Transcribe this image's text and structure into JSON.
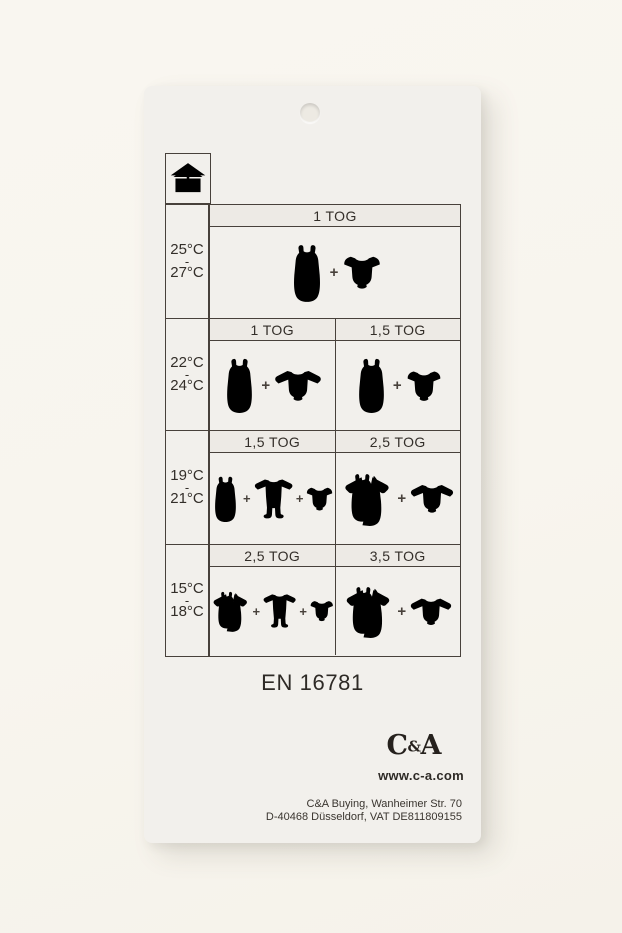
{
  "colors": {
    "backdrop": "#f8f5ee",
    "tag": "#f2f0ec",
    "ink": "#48413b",
    "text": "#332e29",
    "icon_fill": "#e9e6e1",
    "header_bg": "#edeae5"
  },
  "legend": {
    "icon": "house-thermometer-icon"
  },
  "table": {
    "plus": "+",
    "rows": [
      {
        "temp_from": "25°C",
        "temp_sep": "-",
        "temp_to": "27°C",
        "cells": [
          {
            "tog": "1 TOG",
            "items": [
              "sleeping-bag-icon",
              "bodysuit-short-sleeve-icon"
            ]
          }
        ]
      },
      {
        "temp_from": "22°C",
        "temp_sep": "-",
        "temp_to": "24°C",
        "cells": [
          {
            "tog": "1 TOG",
            "items": [
              "sleeping-bag-icon",
              "bodysuit-long-sleeve-icon"
            ]
          },
          {
            "tog": "1,5 TOG",
            "items": [
              "sleeping-bag-icon",
              "bodysuit-short-sleeve-icon"
            ]
          }
        ]
      },
      {
        "temp_from": "19°C",
        "temp_sep": "-",
        "temp_to": "21°C",
        "cells": [
          {
            "tog": "1,5 TOG",
            "items": [
              "sleeping-bag-icon",
              "sleepsuit-icon",
              "bodysuit-short-sleeve-icon"
            ]
          },
          {
            "tog": "2,5 TOG",
            "items": [
              "sleeping-bag-sleeved-icon",
              "bodysuit-long-sleeve-icon"
            ]
          }
        ]
      },
      {
        "temp_from": "15°C",
        "temp_sep": "-",
        "temp_to": "18°C",
        "cells": [
          {
            "tog": "2,5 TOG",
            "items": [
              "sleeping-bag-sleeved-icon",
              "sleepsuit-icon",
              "bodysuit-short-sleeve-icon"
            ]
          },
          {
            "tog": "3,5 TOG",
            "items": [
              "sleeping-bag-sleeved-icon",
              "bodysuit-long-sleeve-icon"
            ]
          }
        ]
      }
    ]
  },
  "footer": {
    "standard": "EN 16781",
    "logo": {
      "c": "C",
      "amp": "&",
      "a": "A"
    },
    "website": "www.c-a.com",
    "address_line1": "C&A Buying, Wanheimer Str. 70",
    "address_line2": "D-40468 Düsseldorf, VAT DE811809155"
  }
}
